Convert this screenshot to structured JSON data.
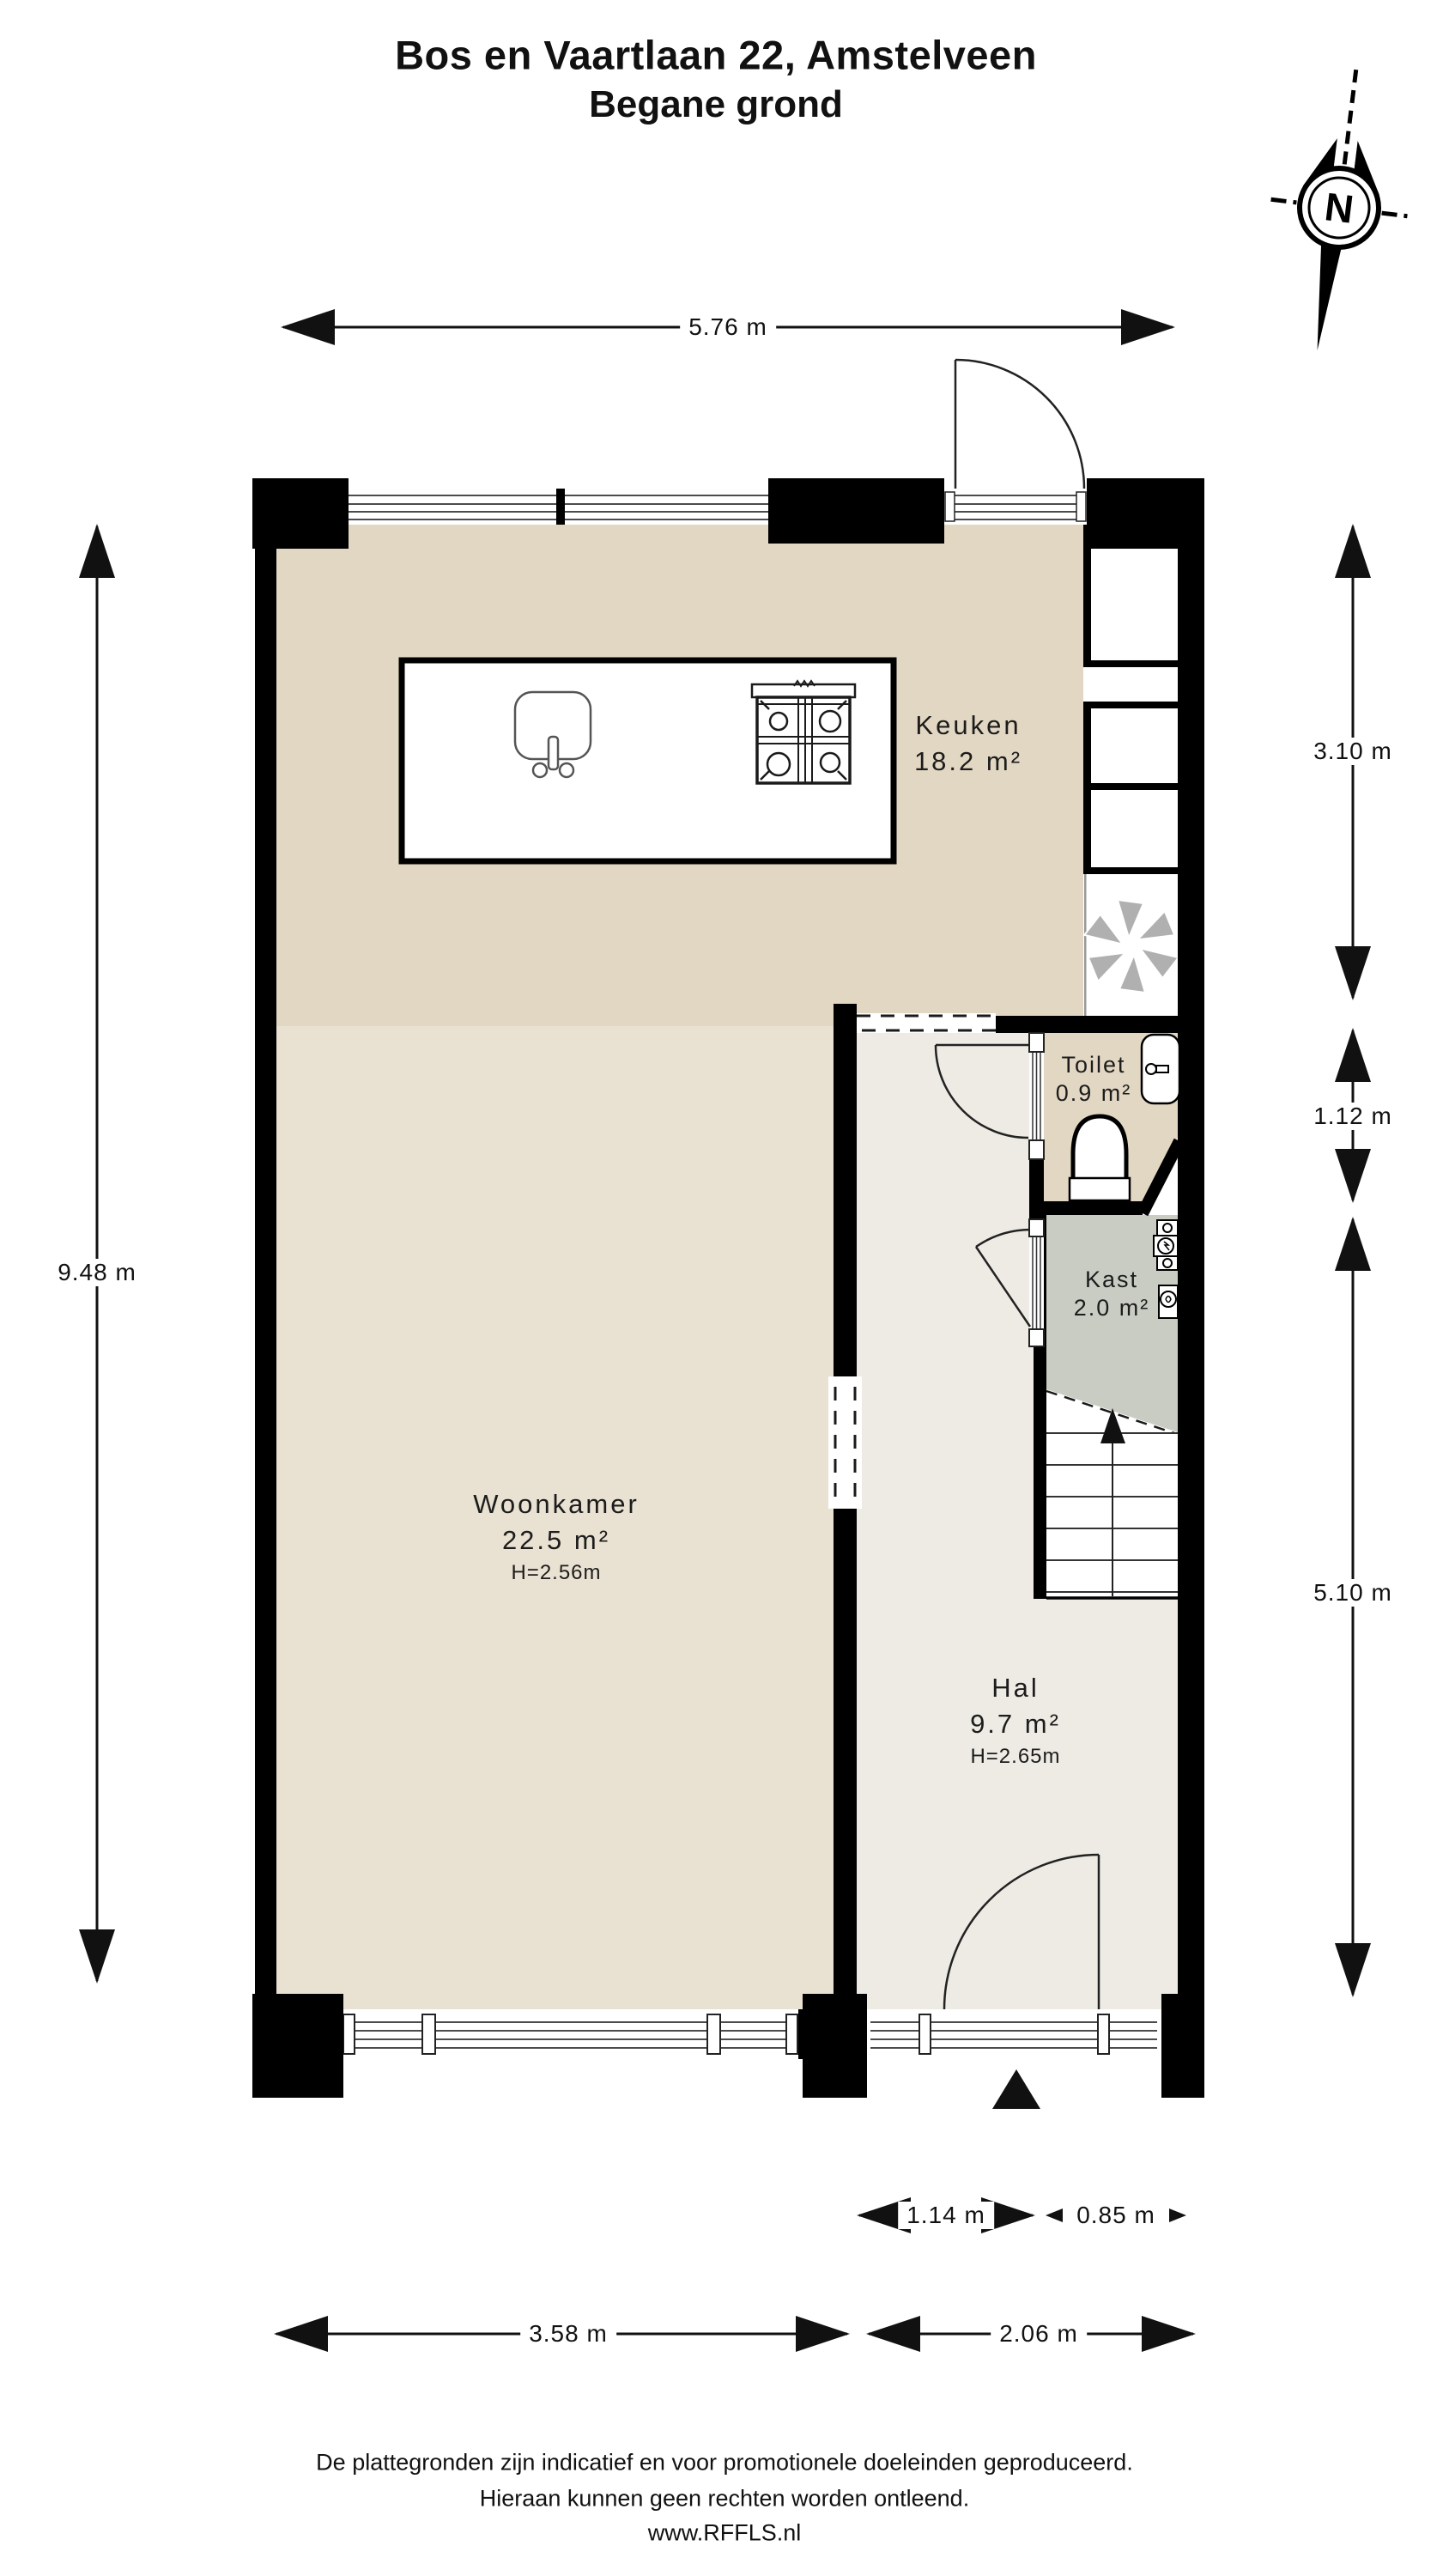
{
  "title": {
    "line1": "Bos en Vaartlaan 22, Amstelveen",
    "line2": "Begane grond"
  },
  "compass": {
    "label": "N"
  },
  "rooms": {
    "keuken": {
      "name": "Keuken",
      "area": "18.2 m²"
    },
    "woonkamer": {
      "name": "Woonkamer",
      "area": "22.5 m²",
      "ceiling": "H=2.56m"
    },
    "hal": {
      "name": "Hal",
      "area": "9.7 m²",
      "ceiling": "H=2.65m"
    },
    "toilet": {
      "name": "Toilet",
      "area": "0.9 m²"
    },
    "kast": {
      "name": "Kast",
      "area": "2.0 m²"
    }
  },
  "dimensions": {
    "top_width": "5.76 m",
    "left_height": "9.48 m",
    "right_top": "3.10 m",
    "right_middle": "1.12 m",
    "right_bottom": "5.10 m",
    "bottom_door": "1.14 m",
    "bottom_door_side": "0.85 m",
    "bottom_left": "3.58 m",
    "bottom_right": "2.06 m"
  },
  "footer": {
    "line1": "De plattegronden zijn indicatief en voor promotionele doeleinden geproduceerd.",
    "line2": "Hieraan kunnen geen rechten worden ontleend.",
    "line3": "www.RFFLS.nl"
  },
  "colors": {
    "keuken_floor": "#e2d7c3",
    "woonkamer_floor": "#e9e1d1",
    "hal_floor": "#edebe4",
    "toilet_floor": "#e2d7c3",
    "kast_floor": "#c9ccc3",
    "wall": "#000000",
    "fixture_line": "#333333",
    "fan_gray": "#b0b0b0"
  },
  "icons": {
    "compass": "north-arrow",
    "sink": "kitchen-sink",
    "stove": "4-burner-hob",
    "fan": "ventilation-asterisk",
    "toilet": "wc-bowl",
    "washbasin": "fontein",
    "meters": "utility-meters",
    "entrance": "entrance-triangle",
    "stairs": "stairs-up"
  }
}
